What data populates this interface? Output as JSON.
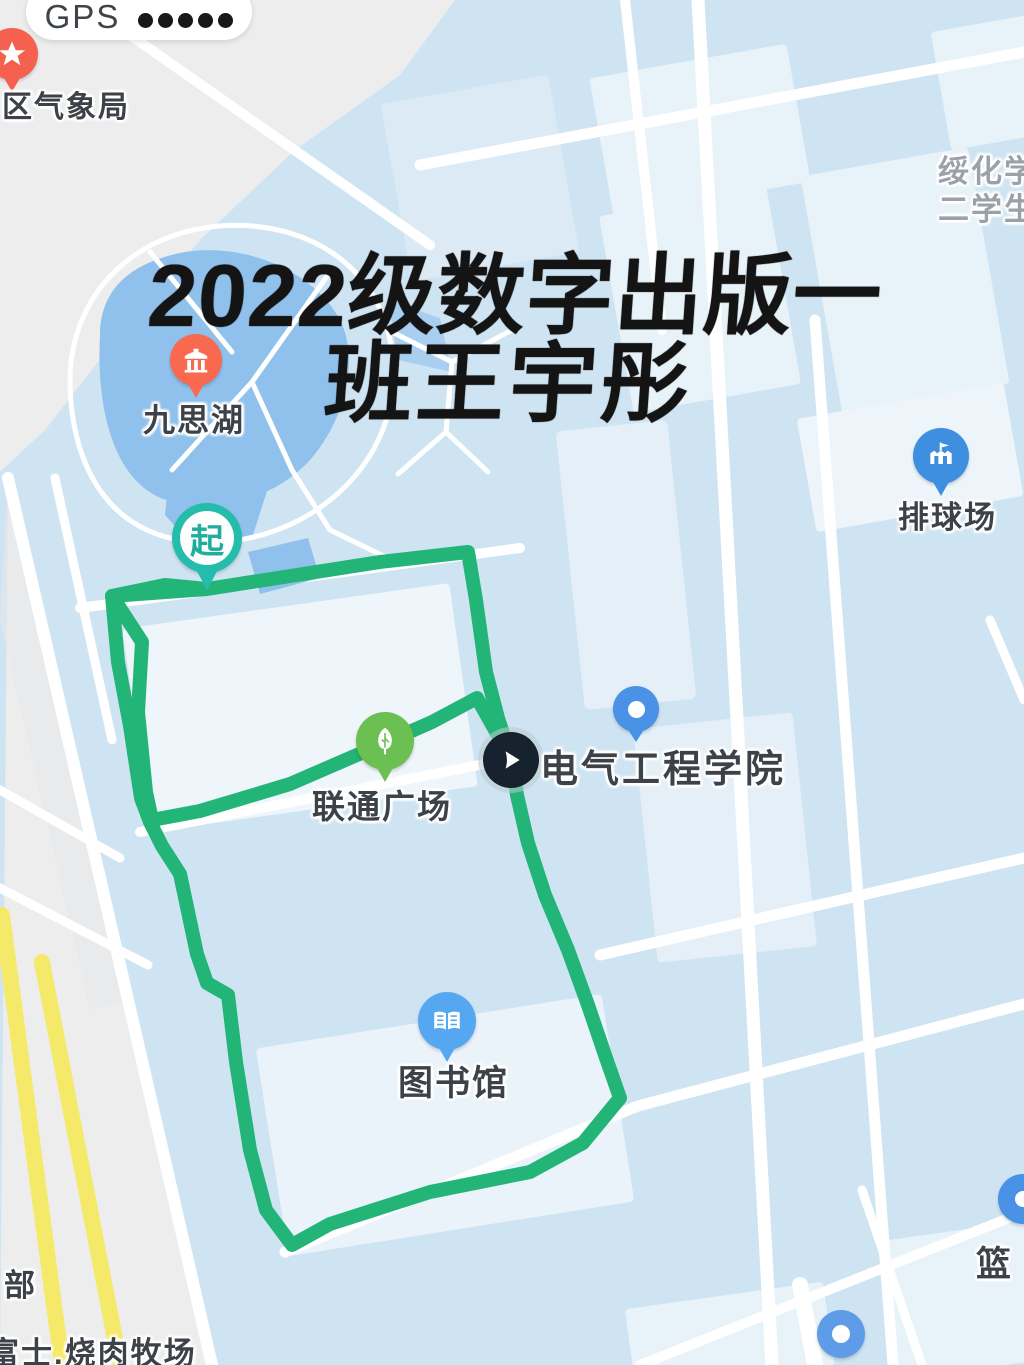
{
  "status_bar": {
    "gps_label": "GPS",
    "signal_dots": 5
  },
  "overlay_title": {
    "line1": "2022级数字出版一",
    "line2": "班王宇彤"
  },
  "labels": {
    "weather_station": "区气象局",
    "lake": "九思湖",
    "campus_line1": "绥化学",
    "campus_line2": "二学生",
    "volleyball_court": "排球场",
    "start_marker": "起",
    "unicom_plaza": "联通广场",
    "electrical_college": "电气工程学院",
    "library": "图书馆",
    "basketball": "篮",
    "department": "部",
    "bbq_restaurant": "富士.烧肉牧场"
  },
  "colors": {
    "route_green": "#23b577",
    "map_blue": "#cfe4f2",
    "building_pale": "#e8f2f9",
    "lake_blue": "#8fc1ec",
    "gray_zone": "#ededee",
    "yellow_road": "#f5e969",
    "pin_red": "#f6604f",
    "pin_orange": "#f8694f",
    "pin_blue": "#4a92e5",
    "pin_lightblue": "#55a7f2",
    "pin_green": "#6cbf51",
    "start_teal": "#24bcab",
    "play_dark": "#16222d"
  }
}
